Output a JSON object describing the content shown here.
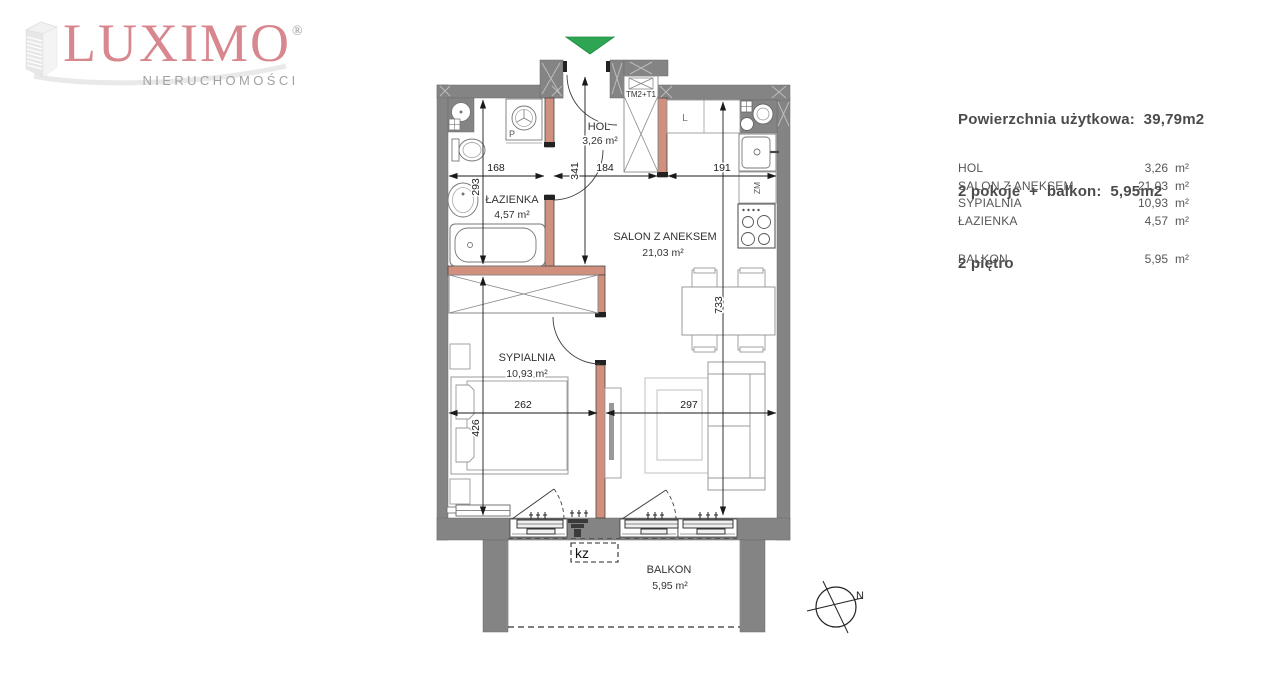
{
  "logo": {
    "brand": "LUXIMO",
    "registered": "®",
    "subtitle": "NIERUCHOMOŚCI"
  },
  "summary": {
    "line1": "Powierzchnia użytkowa:  39,79m2",
    "line2": "2 pokoje  +  balkon:  5,95m2",
    "line3": "2 piętro"
  },
  "room_table": {
    "rows": [
      {
        "name": "HOL",
        "value": "3,26",
        "unit": "m²"
      },
      {
        "name": "SALON Z ANEKSEM",
        "value": "21,03",
        "unit": "m²"
      },
      {
        "name": "SYPIALNIA",
        "value": "10,93",
        "unit": "m²"
      },
      {
        "name": "ŁAZIENKA",
        "value": "4,57",
        "unit": "m²"
      },
      {
        "name": "BALKON",
        "value": "5,95",
        "unit": "m²"
      }
    ]
  },
  "plan": {
    "rooms": {
      "hol": {
        "name": "HOL",
        "area": "3,26 m²"
      },
      "salon": {
        "name": "SALON Z ANEKSEM",
        "area": "21,03 m²"
      },
      "sypialnia": {
        "name": "SYPIALNIA",
        "area": "10,93 m²"
      },
      "lazienka": {
        "name": "ŁAZIENKA",
        "area": "4,57 m²"
      },
      "balkon": {
        "name": "BALKON",
        "area": "5,95 m²"
      }
    },
    "dimensions": {
      "bathroom_width": "168",
      "hall_width": "184",
      "kitchen_width": "191",
      "bathroom_depth": "293",
      "hall_depth": "341",
      "salon_depth": "733",
      "bedroom_width": "262",
      "salon_width": "297",
      "bedroom_depth": "426"
    },
    "tags": {
      "shaft": "TM2+T1",
      "fridge": "L",
      "dishwasher": "ZM",
      "washing_machine": "P",
      "ac_unit": "kz",
      "north": "N"
    },
    "colors": {
      "wall": "#848484",
      "partition": "#d18f7d",
      "entry_arrow": "#2ea552",
      "brand_rose": "#d8878f"
    }
  }
}
